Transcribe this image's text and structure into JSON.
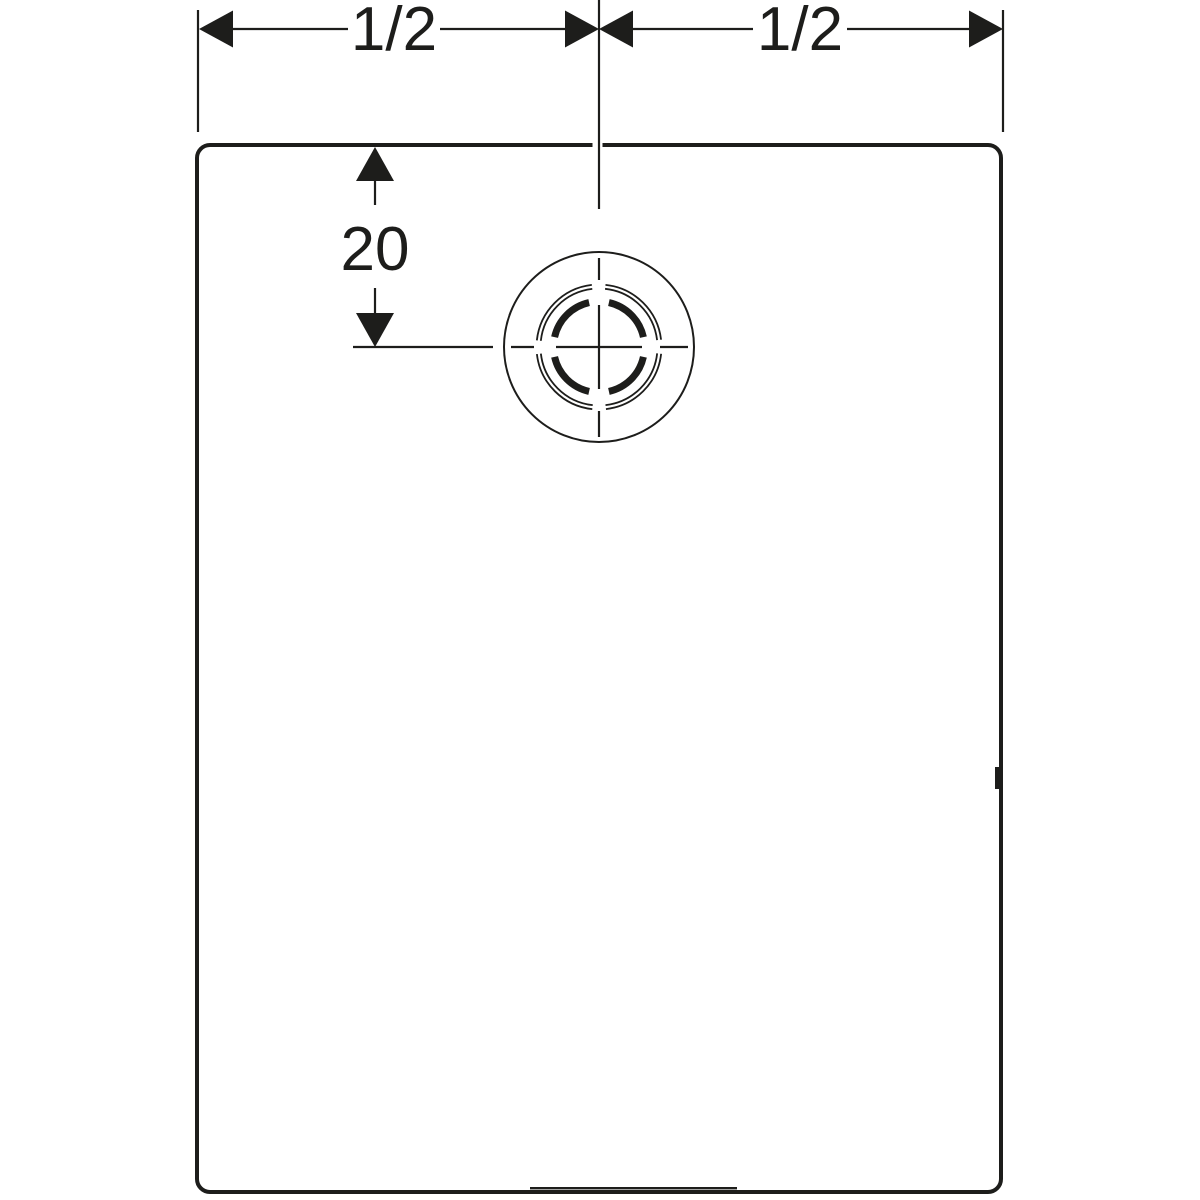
{
  "drawing": {
    "kind": "technical-dimension-drawing",
    "subject": "rectangular tray plan view with offset drain",
    "colors": {
      "line": "#1d1d1b",
      "background": "#ffffff"
    },
    "dimensions": {
      "top_left_width": {
        "label": "1/2"
      },
      "top_right_width": {
        "label": "1/2"
      },
      "drain_offset_from_top_edge": {
        "label": "20"
      }
    }
  }
}
